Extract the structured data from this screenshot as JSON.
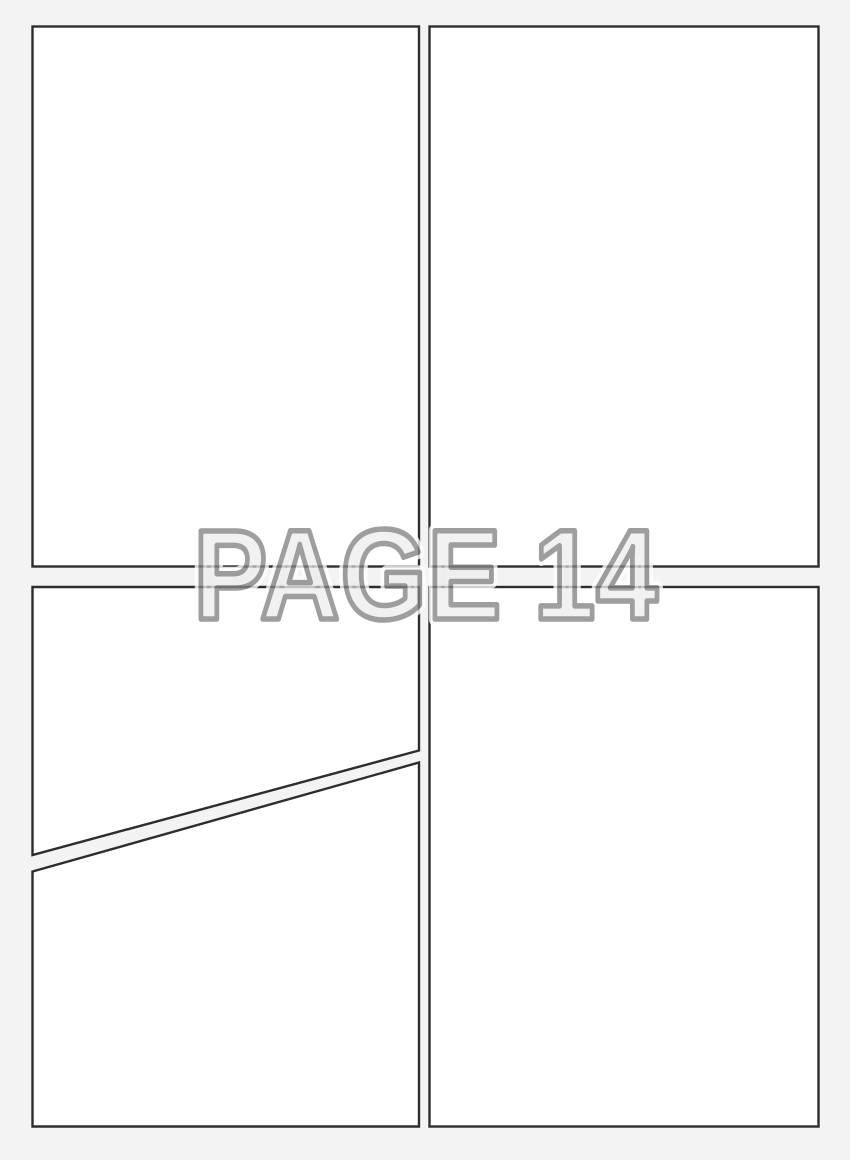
{
  "overlay": {
    "label": "PAGE 14"
  },
  "colors": {
    "background": "#f3f3f3",
    "panel_fill": "#ffffff",
    "panel_border": "#2d2d2d",
    "label_fill": "#eaeaea",
    "label_stroke": "#838383",
    "label_halo": "#ffffff"
  },
  "panels": {
    "count": 5,
    "names": [
      "top-left",
      "top-right",
      "bottom-left-upper",
      "bottom-left-lower",
      "bottom-right"
    ]
  }
}
